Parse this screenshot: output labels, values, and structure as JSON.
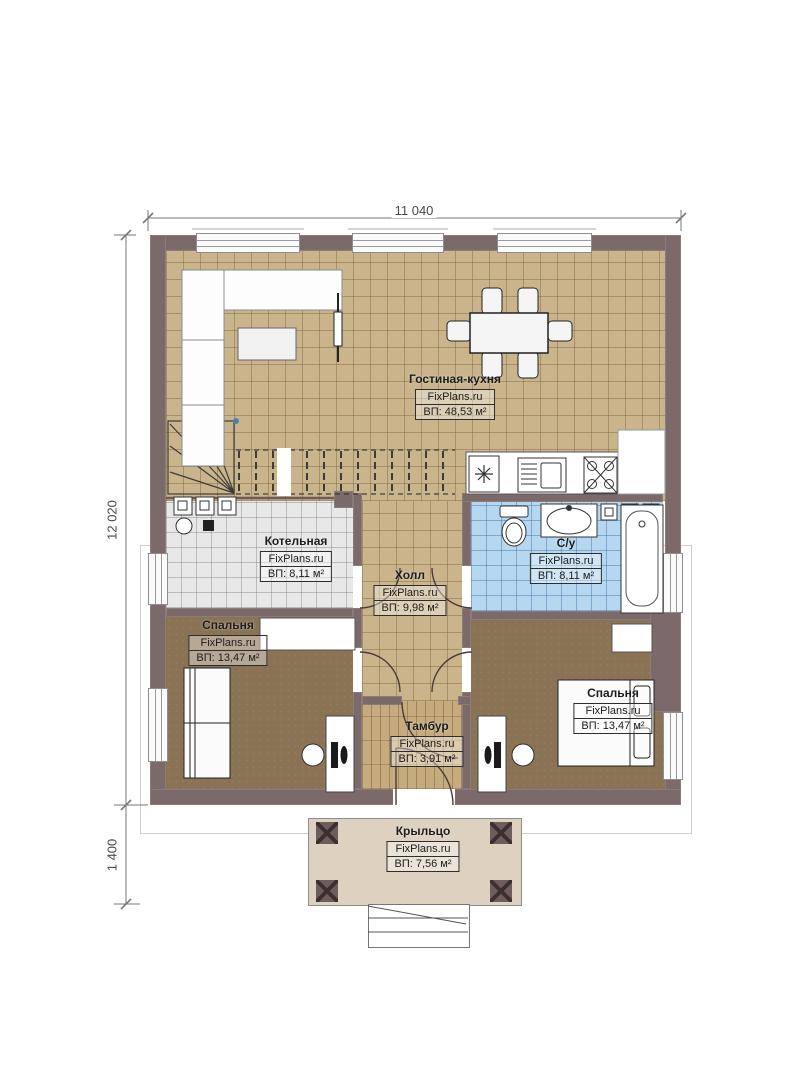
{
  "plan": {
    "brand": "FixPlans.ru",
    "dimensions": {
      "width_label": "11 040",
      "height_label": "12 020",
      "porch_height_label": "1 400"
    },
    "rooms": [
      {
        "name": "Гостиная-кухня",
        "area": "ВП: 48,53 м²"
      },
      {
        "name": "Котельная",
        "area": "ВП: 8,11 м²"
      },
      {
        "name": "Холл",
        "area": "ВП: 9,98 м²"
      },
      {
        "name": "С/у",
        "area": "ВП: 8,11 м²"
      },
      {
        "name": "Спальня",
        "area": "ВП: 13,47 м²"
      },
      {
        "name": "Спальня",
        "area": "ВП: 13,47 м²"
      },
      {
        "name": "Тамбур",
        "area": "ВП: 3,91 м²"
      },
      {
        "name": "Крыльцо",
        "area": "ВП: 7,56 м²"
      }
    ],
    "colors": {
      "wall": "#7c6969",
      "floor_living": "#cab48c",
      "floor_boiler": "#e8e8e8",
      "floor_bathroom": "#b5d7ef",
      "floor_bedroom": "#8a7355",
      "floor_vestibule": "#c6ab7e",
      "porch": "#ddd2bf"
    },
    "furniture_icons": [
      "sofa",
      "coffee-table",
      "tv",
      "dining-table",
      "chair",
      "stairs",
      "fridge",
      "kitchen-sink",
      "stove",
      "toilet",
      "washbasin",
      "bathtub",
      "washing-machine",
      "boiler-equipment",
      "bed",
      "wardrobe",
      "desk",
      "office-chair",
      "porch-steps"
    ]
  }
}
